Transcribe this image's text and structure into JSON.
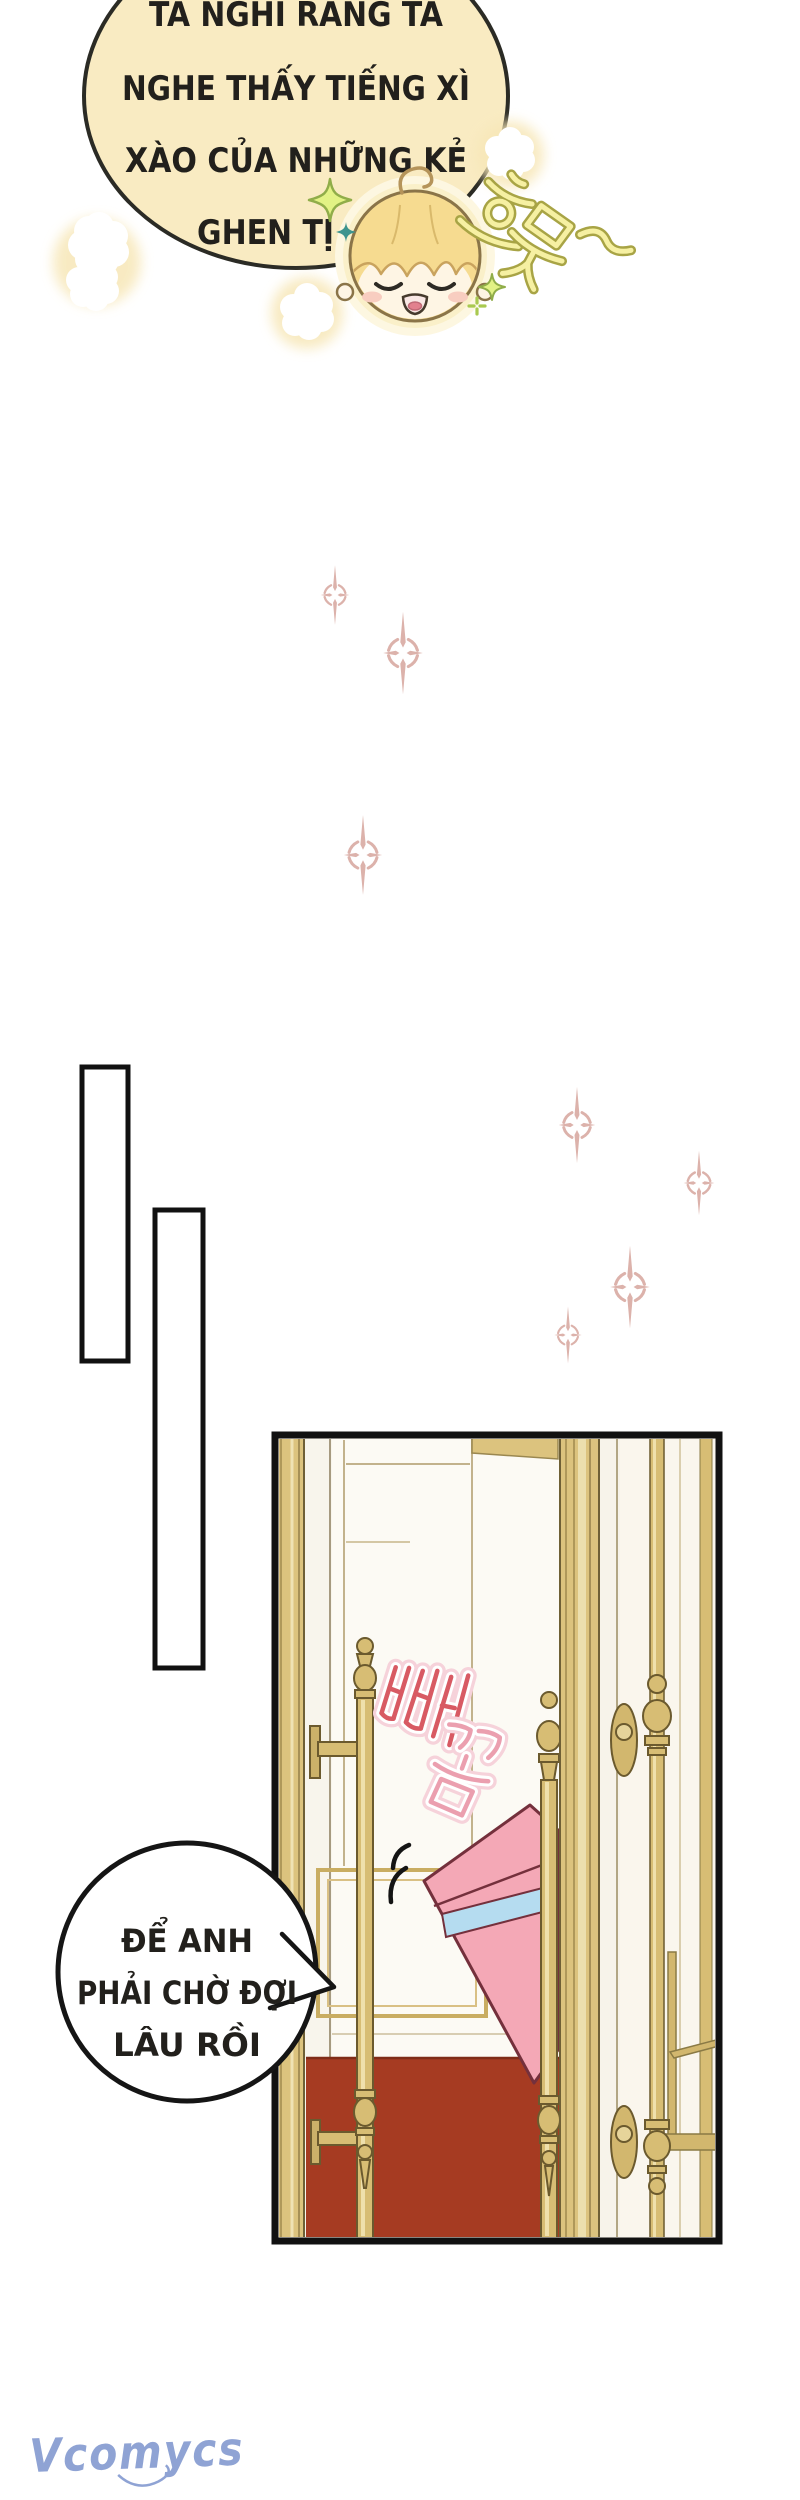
{
  "page": {
    "type": "manhwa-comic-page",
    "background": "#ffffff"
  },
  "bubbles": {
    "top": {
      "lines": [
        "TA NGHĨ RẰNG TA",
        "NGHE THẤY TIẾNG XÌ",
        "XÀO CỦA NHỮNG KẺ",
        "GHEN TỊ ĐÓ"
      ],
      "fill": "#f9ebc2",
      "stroke": "#2b2b25"
    },
    "bottom": {
      "lines": [
        "ĐỂ ANH",
        "PHẢI CHỜ ĐỢI",
        "LÂU RỒI"
      ],
      "fill": "#ffffff",
      "stroke": "#151515"
    }
  },
  "sfx": {
    "smug": {
      "text": "흐뭇~",
      "fill": "#f6f0a2",
      "outline": "#a8a445"
    },
    "peek": {
      "text": "빼꼼",
      "colors": [
        "#d85a63",
        "#eb9faf"
      ],
      "outline": "#ffffff",
      "glow": "#f6d2da"
    }
  },
  "character": {
    "name": "chibi-blonde-boy",
    "expression": "content smile, closed eyes",
    "hair_color": "#f6db90",
    "skin_color": "#fef5e4"
  },
  "panel": {
    "description": "palace door ajar with gold pull handles, pink gift box poking through gap, red carpet",
    "border": "#111111",
    "frame_gold": "#dcc37e",
    "handle_gold": "#d7bd74",
    "door_white": "#faf6ed",
    "carpet_red": "#a63b22",
    "gift_box": {
      "fill": "#f4a8b6",
      "ribbon": "#b5dcf0",
      "outline": "#74303c"
    }
  },
  "decor": {
    "pink_sparkle": "#dcb2ab",
    "green_star_fill": "#e2f285",
    "green_star_stroke": "#90ad49",
    "teal_star": "#3e948e",
    "cloud_white": "#ffffff",
    "cloud_halo": "#f7e7b8"
  },
  "watermark": {
    "text": "Vcomycs",
    "color": "#8fa3d4"
  }
}
